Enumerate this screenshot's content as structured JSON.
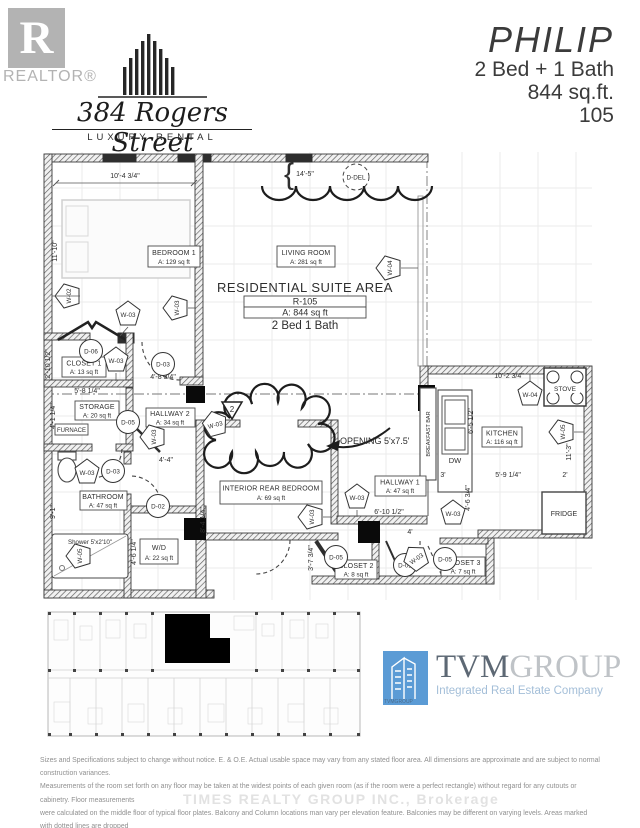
{
  "header": {
    "realtor_letter": "R",
    "realtor_label": "REALTOR®",
    "building_name": "384 Rogers Street",
    "tagline": "LUXURY RENTAL"
  },
  "unit": {
    "name": "PHILIP",
    "config": "2 Bed + 1 Bath",
    "area": "844 sq.ft.",
    "number": "105"
  },
  "suite": {
    "title": "RESIDENTIAL SUITE AREA",
    "code": "R-105",
    "area": "A: 844 sq ft",
    "config": "2 Bed 1 Bath"
  },
  "rooms": {
    "bedroom1": {
      "name": "BEDROOM 1",
      "area": "A: 129 sq ft"
    },
    "living": {
      "name": "LIVING ROOM",
      "area": "A: 281 sq ft"
    },
    "closet1": {
      "name": "CLOSET 1",
      "area": "A: 13 sq ft"
    },
    "storage": {
      "name": "STORAGE",
      "area": "A: 20 sq ft"
    },
    "furnace": {
      "name": "FURNACE"
    },
    "hallway2": {
      "name": "HALLWAY 2",
      "area": "A: 34 sq ft"
    },
    "bathroom": {
      "name": "BATHROOM",
      "area": "A: 47 sq ft"
    },
    "shower": {
      "name": "Shower 5'x2'10\""
    },
    "wd": {
      "name": "W/D",
      "area": "A: 22 sq ft"
    },
    "rear_bedroom": {
      "name": "INTERIOR REAR BEDROOM",
      "area": "A: 69 sq ft"
    },
    "hallway1": {
      "name": "HALLWAY 1",
      "area": "A: 47 sq ft"
    },
    "kitchen": {
      "name": "KITCHEN",
      "area": "A: 116 sq ft"
    },
    "closet2": {
      "name": "CLOSET 2",
      "area": "A: 8 sq ft"
    },
    "closet3": {
      "name": "CLOSET 3",
      "area": "A: 7 sq ft"
    },
    "stove": "STOVE",
    "fridge": "FRIDGE",
    "dw": "DW",
    "breakfast_bar": "BREAKFAST BAR"
  },
  "annotations": {
    "opening": "OPENING 5'x7.5'",
    "section_marker": "2",
    "brace": "{"
  },
  "door_tags": [
    "D-DEL",
    "D-06",
    "D-03",
    "D-05",
    "D-03",
    "D-02",
    "D-05",
    "D-01",
    "D-05"
  ],
  "wall_tags": [
    "W-02",
    "W-03",
    "W-03",
    "W-03",
    "W-04",
    "W-03",
    "W-03",
    "W-03",
    "W-03",
    "W-03",
    "W-03",
    "W-04",
    "W-05",
    "W-05",
    "W-03"
  ],
  "dimensions": {
    "bedroom_width": "10'-4 3/4\"",
    "living_width": "14'-5\"",
    "bedroom_depth": "11'-10\"",
    "closet1_height": "2'-10 1/2\"",
    "storage_width": "5'-8 1/4\"",
    "bedroom_door": "4'-8 3/4\"",
    "storage_height": "4'-1 1/4\"",
    "hallway2_width": "4'-4\"",
    "bathroom_height": "9'-1\"",
    "wd_height": "4'-6 1/4\"",
    "rear_bedroom_height": "8'-4 1/4\"",
    "closet2_height": "3'-7 3/4\"",
    "hallway1_width": "6'-10 1/2\"",
    "entry_width": "4'",
    "kitchen_width": "10'-2 3/4\"",
    "kitchen_height": "6'-5 1/2\"",
    "bar_width": "3'",
    "kitchen_mid_width": "5'-9 1/4\"",
    "counter_depth": "2'",
    "kitchen_depth": "11'-3\"",
    "fridge_height": "4'-6 3/4\""
  },
  "footer": {
    "tvm": "TVM",
    "group": "GROUP",
    "subtitle": "Integrated Real Estate Company",
    "icon_caption": "TVMGROUP",
    "legal_lines": [
      "Sizes and Specifications subject to change without notice. E. & O.E. Actual usable space may vary from any stated floor area. All dimensions are approximate and are subject to normal construction variances.",
      "Measurements of the room set forth on any floor may be taken at the widest points of each given room (as if the room were a perfect rectangle) without regard for any cutouts or cabinetry. Floor measurements",
      "were calculated on the middle floor of typical floor plates. Balcony and Column locations man vary per elevation feature. Balconies may be different on varying levels. Areas marked with dotted lines are dropped",
      "ceiling areas. Additional ceiling areas may be dropped to accommodate bulkheads or for any other reason required by the Vendor"
    ],
    "watermark": "TIMES REALTY GROUP INC., Brokerage"
  },
  "colors": {
    "tvm_blue": "#5b9bd5",
    "realtor_gray": "#b3b3b3",
    "line_dark": "#2e2e2e"
  }
}
